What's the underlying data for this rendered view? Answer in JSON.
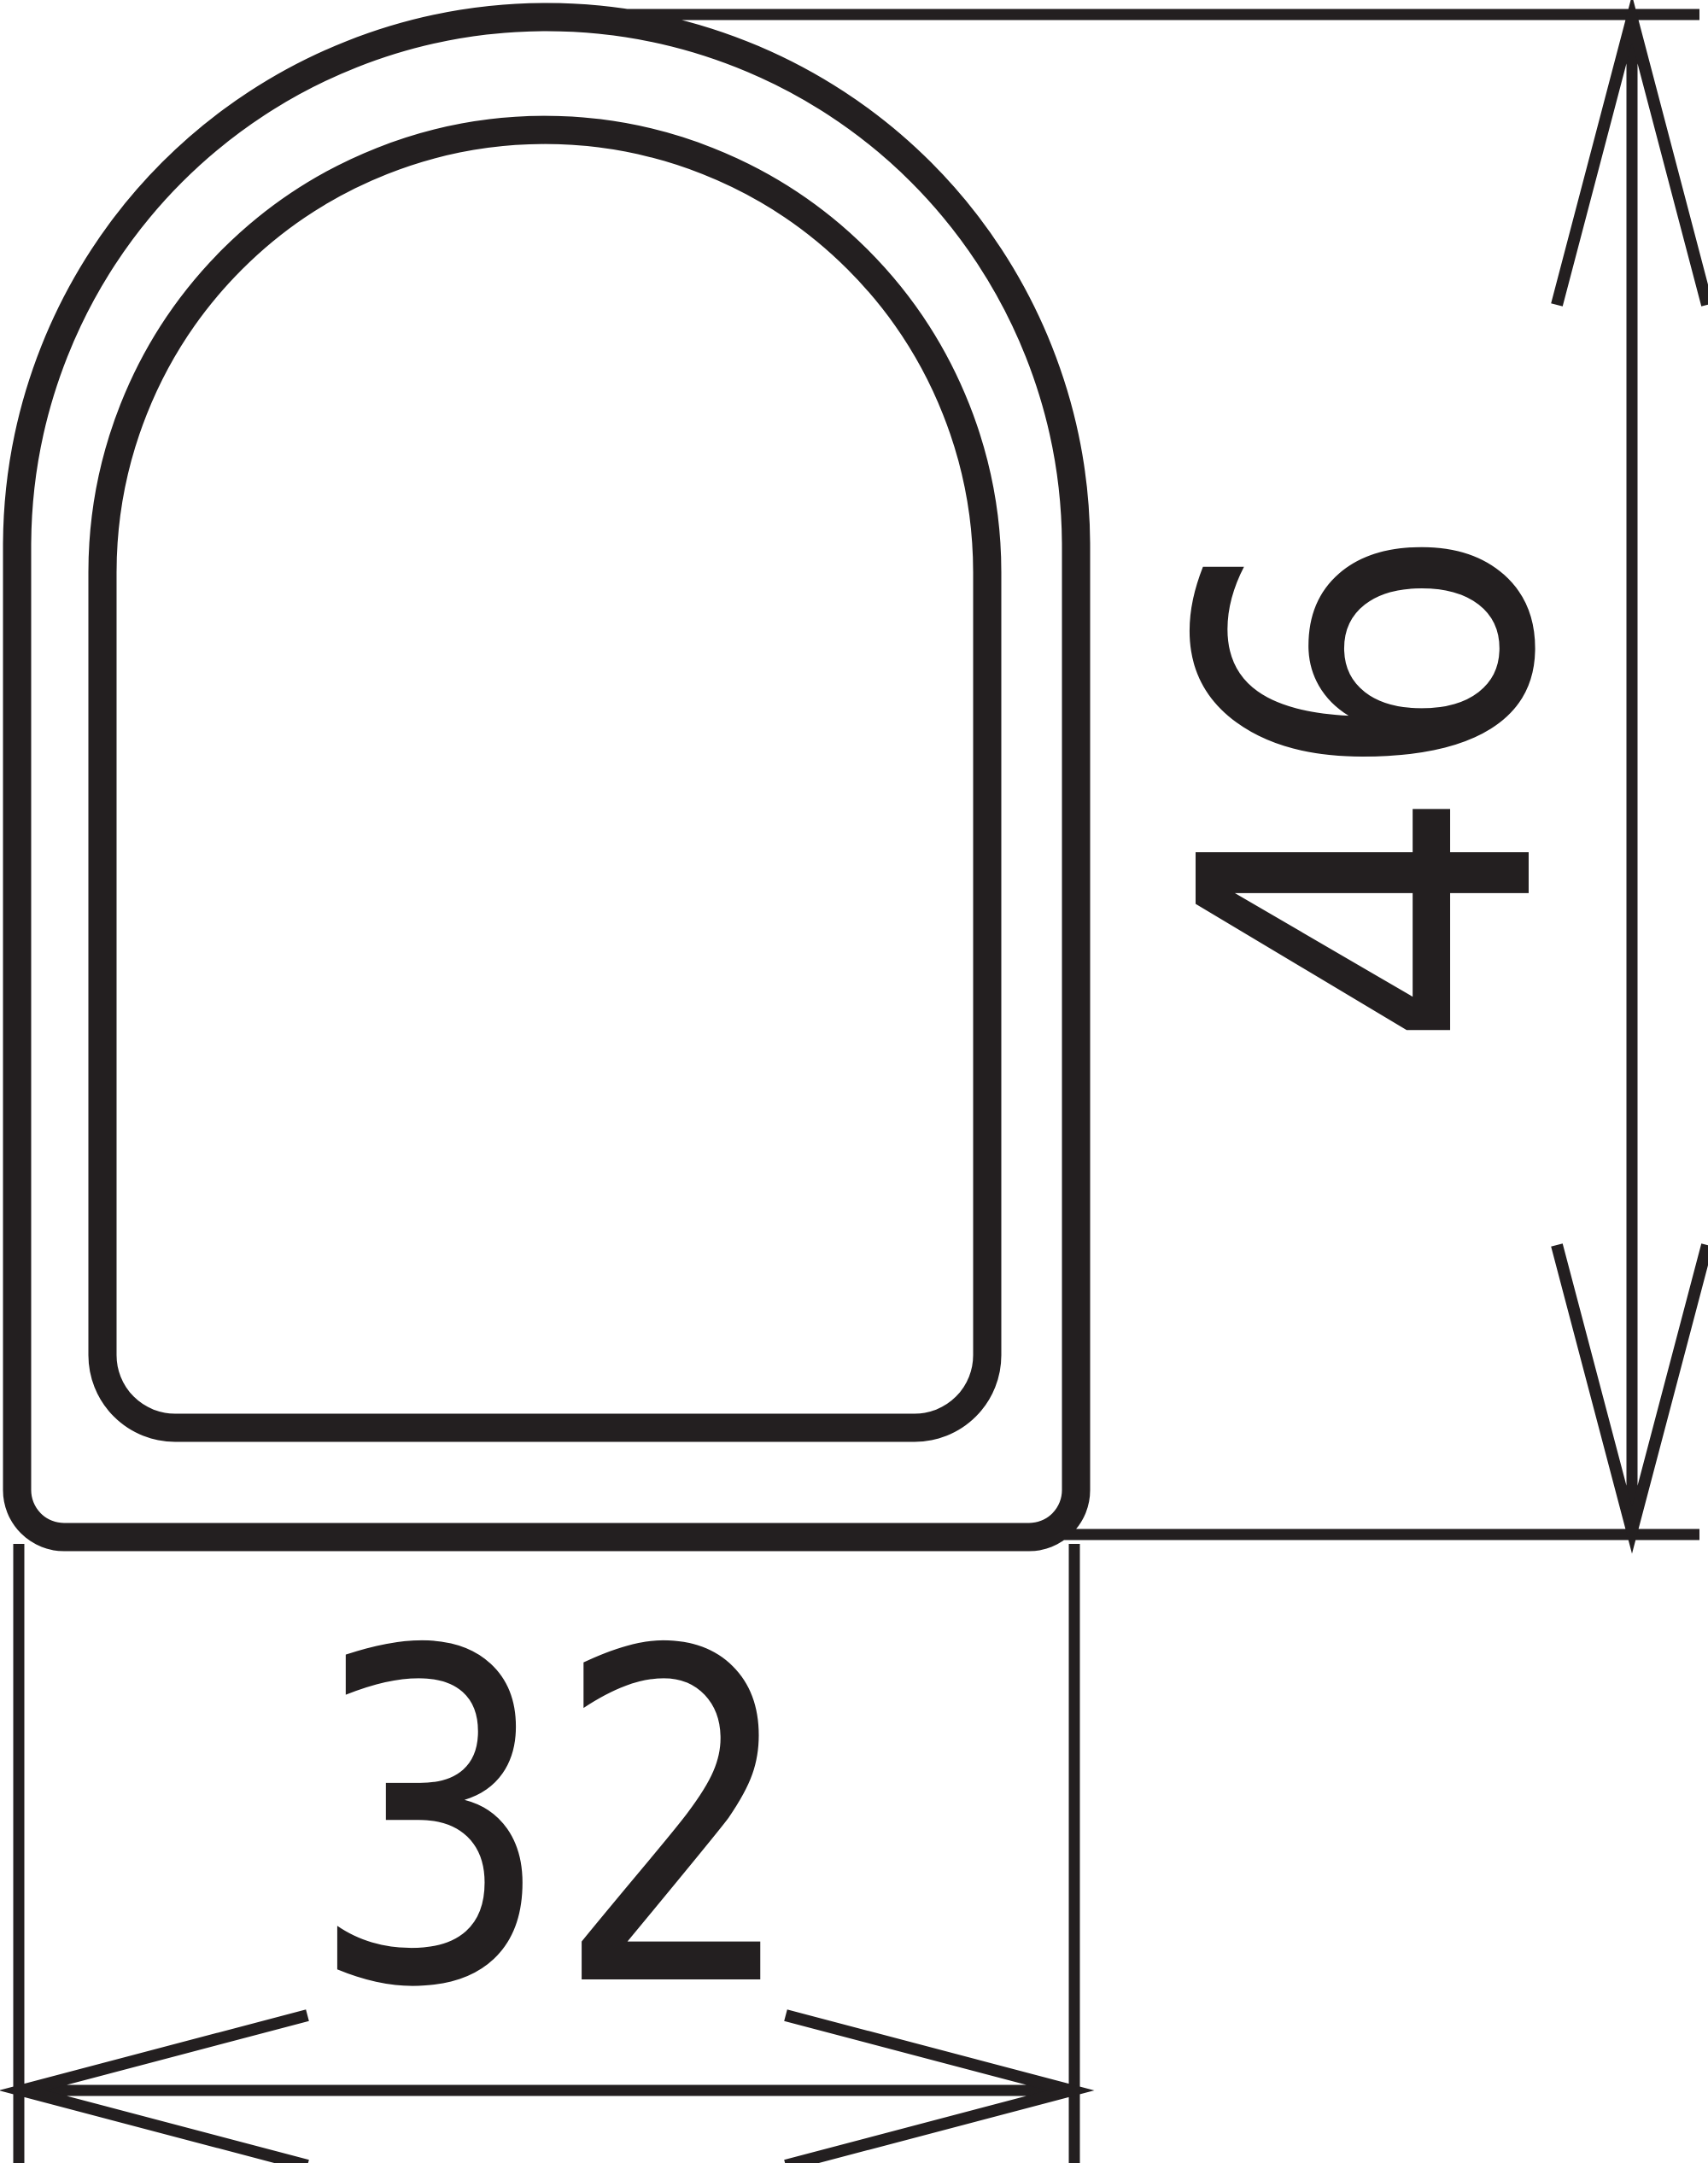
{
  "drawing": {
    "height_dimension": {
      "value": "46",
      "orientation": "vertical"
    },
    "width_dimension": {
      "value": "32",
      "orientation": "horizontal"
    },
    "colors": {
      "line": "#231f20",
      "background": "#ffffff"
    }
  }
}
